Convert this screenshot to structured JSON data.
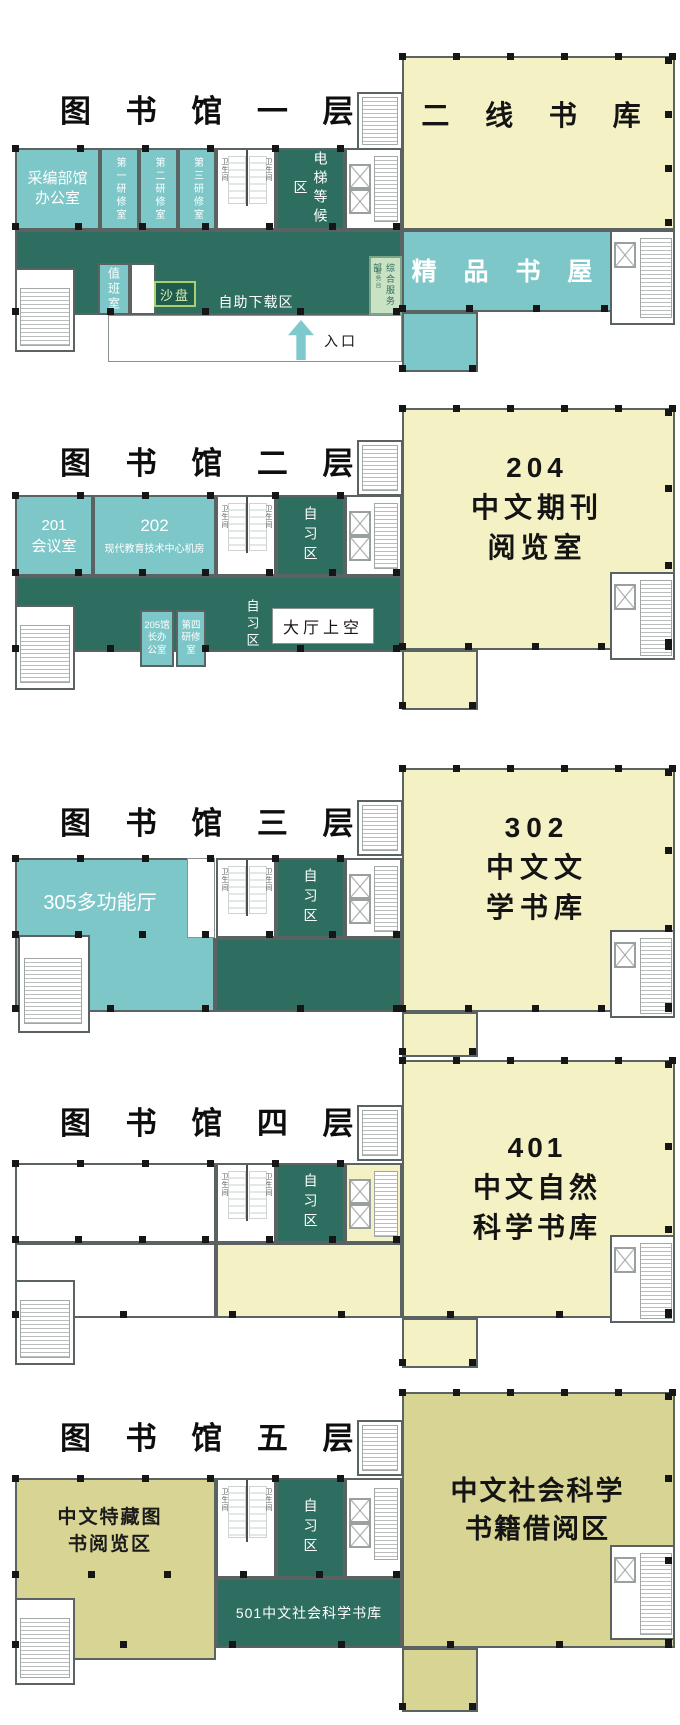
{
  "colors": {
    "teal_room": "#7ec7c9",
    "dark_green": "#2e6e60",
    "pale_yellow": "#f4f2c4",
    "olive": "#d8d494",
    "service_green": "#c9e2c4",
    "arrow_teal": "#7fc9cc",
    "sand_fill": "#1f5c4e",
    "sand_border": "#a9cf6e"
  },
  "floors": [
    {
      "title": "图 书 馆 一 层",
      "rooms": {
        "secondary_stack": "二 线 书 库",
        "boutique_bookhouse": "精 品 书 屋",
        "acquisition_line1": "采编部馆",
        "acquisition_line2": "办公室",
        "study_room_1": "第一研修室",
        "study_room_2": "第二研修室",
        "study_room_3": "第三研修室",
        "toilet": "卫生间",
        "elevator_waiting": "电梯等候区",
        "duty_room": "值班室",
        "sand_table": "沙盘",
        "self_download": "自助下载区",
        "service_dept": "综合服务部",
        "service_desk": "服务台",
        "entrance": "入口"
      }
    },
    {
      "title": "图 书 馆 二 层",
      "rooms": {
        "reading_num": "204",
        "reading_line1": "中文期刊",
        "reading_line2": "阅览室",
        "meeting_num": "201",
        "meeting_name": "会议室",
        "tech_num": "202",
        "tech_name": "现代教育技术中心机房",
        "study_area": "自习区",
        "dean_office": "205馆长办公室",
        "study_room_4": "第四研修室",
        "hall_void": "大厅上空",
        "toilet": "卫生间"
      }
    },
    {
      "title": "图 书 馆 三 层",
      "rooms": {
        "stack_num": "302",
        "stack_line1": "中文文",
        "stack_line2": "学书库",
        "multifunction": "305多功能厅",
        "study_area": "自习区",
        "toilet": "卫生间"
      }
    },
    {
      "title": "图 书 馆 四 层",
      "rooms": {
        "stack_num": "401",
        "stack_line1": "中文自然",
        "stack_line2": "科学书库",
        "study_area": "自习区",
        "toilet": "卫生间"
      }
    },
    {
      "title": "图 书 馆 五 层",
      "rooms": {
        "social_line1": "中文社会科学",
        "social_line2": "书籍借阅区",
        "special_line1": "中文特藏图",
        "special_line2": "书阅览区",
        "study_area": "自习区",
        "stack_501": "501中文社会科学书库",
        "toilet": "卫生间"
      }
    }
  ]
}
